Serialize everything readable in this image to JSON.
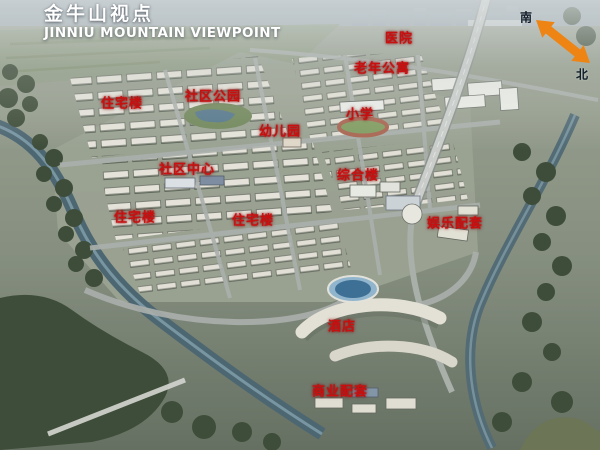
{
  "title": {
    "zh": "金牛山视点",
    "en": "JINNIU MOUNTAIN VIEWPOINT"
  },
  "compass": {
    "south_label": "南",
    "north_label": "北",
    "arrow_color": "#ee8414"
  },
  "label_color": "#c81010",
  "map_labels": [
    {
      "id": "hospital",
      "text": "医院",
      "x": 399,
      "y": 37
    },
    {
      "id": "senior-apartments",
      "text": "老年公寓",
      "x": 382,
      "y": 67
    },
    {
      "id": "community-park",
      "text": "社区公园",
      "x": 213,
      "y": 95
    },
    {
      "id": "residential-1",
      "text": "住宅楼",
      "x": 122,
      "y": 102
    },
    {
      "id": "primary-school",
      "text": "小学",
      "x": 360,
      "y": 113
    },
    {
      "id": "kindergarten",
      "text": "幼儿园",
      "x": 280,
      "y": 130
    },
    {
      "id": "community-center",
      "text": "社区中心",
      "x": 187,
      "y": 168
    },
    {
      "id": "mixed-use-building",
      "text": "综合楼",
      "x": 358,
      "y": 174
    },
    {
      "id": "residential-2",
      "text": "住宅楼",
      "x": 135,
      "y": 216
    },
    {
      "id": "residential-3",
      "text": "住宅楼",
      "x": 253,
      "y": 219
    },
    {
      "id": "entertainment-facilities",
      "text": "娱乐配套",
      "x": 455,
      "y": 222
    },
    {
      "id": "hotel",
      "text": "酒店",
      "x": 342,
      "y": 325
    },
    {
      "id": "commercial-facilities",
      "text": "商业配套",
      "x": 340,
      "y": 390
    }
  ]
}
